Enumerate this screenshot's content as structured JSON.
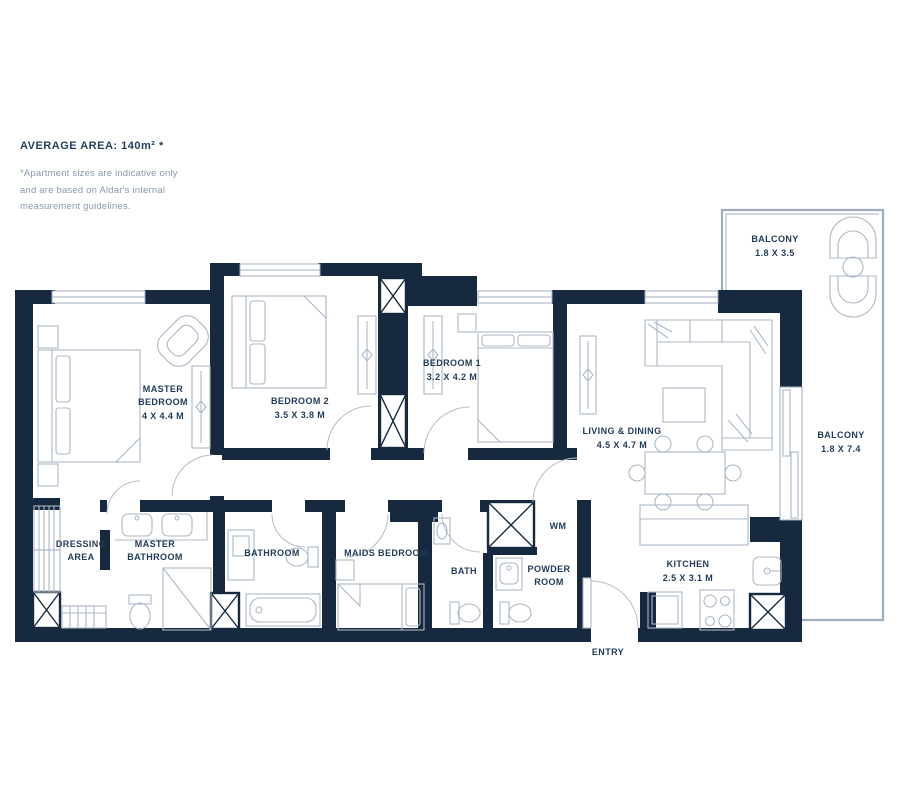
{
  "header": {
    "title": "AVERAGE AREA: 140m² *",
    "disclaimer_lines": [
      "*Apartment sizes are indicative only",
      "and are based on Aldar's internal",
      "measurement guidelines."
    ]
  },
  "colors": {
    "wall": "#16293e",
    "furniture_line": "#acb8c5",
    "label_text": "#1f3b58",
    "disclaimer_text": "#8a99ac",
    "background": "#ffffff"
  },
  "rooms": [
    {
      "id": "master-bedroom",
      "lines": [
        "MASTER",
        "BEDROOM",
        "4 X 4.4 M"
      ]
    },
    {
      "id": "bedroom-2",
      "lines": [
        "BEDROOM 2",
        "3.5 X 3.8 M"
      ]
    },
    {
      "id": "bedroom-1",
      "lines": [
        "BEDROOM 1",
        "3.2 X 4.2 M"
      ]
    },
    {
      "id": "living-dining",
      "lines": [
        "LIVING & DINING",
        "4.5 X 4.7 M"
      ]
    },
    {
      "id": "balcony-1",
      "lines": [
        "BALCONY",
        "1.8 X 3.5"
      ]
    },
    {
      "id": "balcony-2",
      "lines": [
        "BALCONY",
        "1.8 X 7.4"
      ]
    },
    {
      "id": "kitchen",
      "lines": [
        "KITCHEN",
        "2.5 X 3.1 M"
      ]
    },
    {
      "id": "dressing-area",
      "lines": [
        "DRESSING",
        "AREA"
      ]
    },
    {
      "id": "master-bathroom",
      "lines": [
        "MASTER",
        "BATHROOM"
      ]
    },
    {
      "id": "bathroom",
      "lines": [
        "BATHROOM"
      ]
    },
    {
      "id": "maids-bedroom",
      "lines": [
        "MAIDS BEDROOM"
      ]
    },
    {
      "id": "bath",
      "lines": [
        "BATH"
      ]
    },
    {
      "id": "powder-room",
      "lines": [
        "POWDER",
        "ROOM"
      ]
    },
    {
      "id": "wm",
      "lines": [
        "WM"
      ]
    },
    {
      "id": "entry",
      "lines": [
        "ENTRY"
      ]
    }
  ]
}
